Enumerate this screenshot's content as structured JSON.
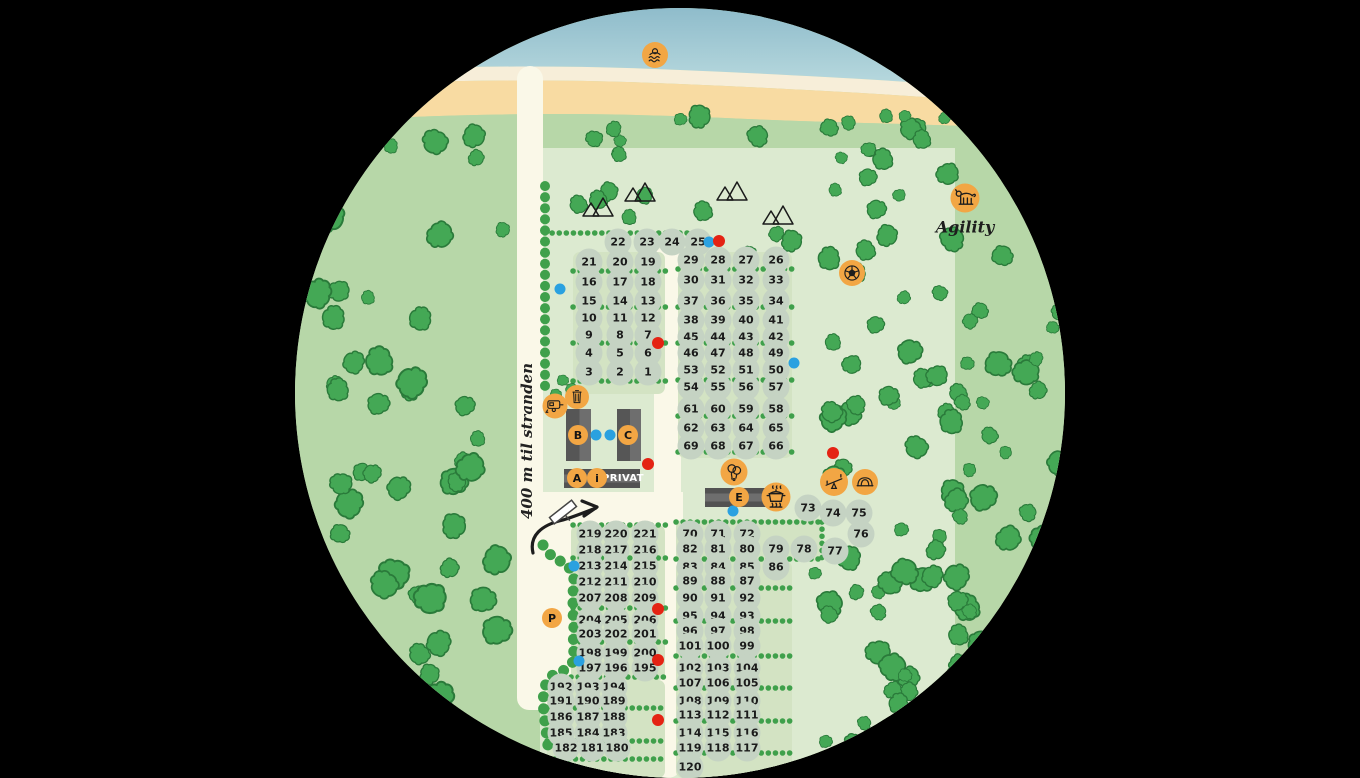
{
  "map": {
    "labels": {
      "road": "400 m til stranden",
      "agility": "Agility",
      "privat": "PRIVAT"
    },
    "colors": {
      "orange": "#f2a644",
      "blue_dot": "#2aa1e0",
      "red_dot": "#e42313",
      "tree": "#44a855",
      "hedge": "#3fa04b",
      "sea_top": "#8fbccb",
      "sea_bottom": "#bcdce0",
      "sand": "#f8dba2",
      "sand_stripe": "#f7eed9",
      "grass_outer": "#b7d7a8",
      "grass_camp": "#dcead0",
      "panel": "#d3e3c3",
      "road": "#faf8e8",
      "pitch": "#c5d3c3",
      "building": "#565656"
    },
    "letter_markers": [
      {
        "label": "B",
        "x": 283,
        "y": 427,
        "name": "building-b-marker"
      },
      {
        "label": "C",
        "x": 333,
        "y": 427,
        "name": "building-c-marker"
      },
      {
        "label": "A",
        "x": 282,
        "y": 470,
        "name": "building-a-marker"
      },
      {
        "label": "i",
        "x": 302,
        "y": 470,
        "name": "info-marker"
      },
      {
        "label": "E",
        "x": 444,
        "y": 489,
        "name": "building-e-marker"
      },
      {
        "label": "P",
        "x": 257,
        "y": 610,
        "name": "parking-marker"
      }
    ],
    "icon_markers": [
      {
        "name": "swimming-icon",
        "icon": "swim",
        "x": 360,
        "y": 47,
        "size": 26
      },
      {
        "name": "dog-agility-icon",
        "icon": "dog",
        "x": 670,
        "y": 190,
        "size": 29
      },
      {
        "name": "caravan-service-icon",
        "icon": "caravan",
        "x": 260,
        "y": 398,
        "size": 25
      },
      {
        "name": "trash-icon",
        "icon": "trash",
        "x": 282,
        "y": 389,
        "size": 24
      },
      {
        "name": "football-icon",
        "icon": "ball",
        "x": 557,
        "y": 265,
        "size": 26
      },
      {
        "name": "balloons-icon",
        "icon": "balloons",
        "x": 439,
        "y": 464,
        "size": 27
      },
      {
        "name": "cooking-pot-icon",
        "icon": "pot",
        "x": 481,
        "y": 489,
        "size": 29
      },
      {
        "name": "seesaw-icon",
        "icon": "seesaw",
        "x": 539,
        "y": 474,
        "size": 28
      },
      {
        "name": "climbing-dome-icon",
        "icon": "dome",
        "x": 570,
        "y": 474,
        "size": 26
      }
    ],
    "blocks": [
      {
        "id": "north-left",
        "rows": [
          {
            "y": 234,
            "xs": [
              323,
              352,
              377,
              403
            ],
            "nums": [
              "22",
              "23",
              "24",
              "25"
            ]
          },
          {
            "y": 254,
            "xs": [
              294,
              325,
              353
            ],
            "nums": [
              "21",
              "20",
              "19"
            ]
          },
          {
            "y": 274,
            "xs": [
              294,
              325,
              353
            ],
            "nums": [
              "16",
              "17",
              "18"
            ]
          },
          {
            "y": 293,
            "xs": [
              294,
              325,
              353
            ],
            "nums": [
              "15",
              "14",
              "13"
            ]
          },
          {
            "y": 310,
            "xs": [
              294,
              325,
              353
            ],
            "nums": [
              "10",
              "11",
              "12"
            ]
          },
          {
            "y": 327,
            "xs": [
              294,
              325,
              353
            ],
            "nums": [
              "9",
              "8",
              "7"
            ]
          },
          {
            "y": 345,
            "xs": [
              294,
              325,
              353
            ],
            "nums": [
              "4",
              "5",
              "6"
            ]
          },
          {
            "y": 364,
            "xs": [
              294,
              325,
              353
            ],
            "nums": [
              "3",
              "2",
              "1"
            ]
          }
        ]
      },
      {
        "id": "north-right",
        "rows": [
          {
            "y": 252,
            "xs": [
              396,
              423,
              451,
              481
            ],
            "nums": [
              "29",
              "28",
              "27",
              "26"
            ]
          },
          {
            "y": 272,
            "xs": [
              396,
              423,
              451,
              481
            ],
            "nums": [
              "30",
              "31",
              "32",
              "33"
            ]
          },
          {
            "y": 293,
            "xs": [
              396,
              423,
              451,
              481
            ],
            "nums": [
              "37",
              "36",
              "35",
              "34"
            ]
          },
          {
            "y": 312,
            "xs": [
              396,
              423,
              451,
              481
            ],
            "nums": [
              "38",
              "39",
              "40",
              "41"
            ]
          },
          {
            "y": 329,
            "xs": [
              396,
              423,
              451,
              481
            ],
            "nums": [
              "45",
              "44",
              "43",
              "42"
            ]
          },
          {
            "y": 345,
            "xs": [
              396,
              423,
              451,
              481
            ],
            "nums": [
              "46",
              "47",
              "48",
              "49"
            ]
          },
          {
            "y": 362,
            "xs": [
              396,
              423,
              451,
              481
            ],
            "nums": [
              "53",
              "52",
              "51",
              "50"
            ]
          },
          {
            "y": 379,
            "xs": [
              396,
              423,
              451,
              481
            ],
            "nums": [
              "54",
              "55",
              "56",
              "57"
            ]
          },
          {
            "y": 401,
            "xs": [
              396,
              423,
              451,
              481
            ],
            "nums": [
              "61",
              "60",
              "59",
              "58"
            ]
          },
          {
            "y": 420,
            "xs": [
              396,
              423,
              451,
              481
            ],
            "nums": [
              "62",
              "63",
              "64",
              "65"
            ]
          },
          {
            "y": 438,
            "xs": [
              396,
              423,
              451,
              481
            ],
            "nums": [
              "69",
              "68",
              "67",
              "66"
            ]
          }
        ]
      },
      {
        "id": "mid-right-70s",
        "rows": [
          {
            "y": 526,
            "xs": [
              395,
              423,
              452
            ],
            "nums": [
              "70",
              "71",
              "72"
            ]
          },
          {
            "y": 541,
            "xs": [
              395,
              423,
              452,
              481,
              509
            ],
            "nums": [
              "82",
              "81",
              "80",
              "79",
              "78"
            ]
          }
        ]
      },
      {
        "id": "south-right",
        "rows": [
          {
            "y": 559,
            "xs": [
              395,
              423,
              452,
              481
            ],
            "nums": [
              "83",
              "84",
              "85",
              "86"
            ]
          },
          {
            "y": 573,
            "xs": [
              395,
              423,
              452
            ],
            "nums": [
              "89",
              "88",
              "87"
            ]
          },
          {
            "y": 590,
            "xs": [
              395,
              423,
              452
            ],
            "nums": [
              "90",
              "91",
              "92"
            ]
          },
          {
            "y": 608,
            "xs": [
              395,
              423,
              452
            ],
            "nums": [
              "95",
              "94",
              "93"
            ]
          },
          {
            "y": 623,
            "xs": [
              395,
              423,
              452
            ],
            "nums": [
              "96",
              "97",
              "98"
            ]
          },
          {
            "y": 638,
            "xs": [
              395,
              423,
              452
            ],
            "nums": [
              "101",
              "100",
              "99"
            ]
          },
          {
            "y": 660,
            "xs": [
              395,
              423,
              452
            ],
            "nums": [
              "102",
              "103",
              "104"
            ]
          },
          {
            "y": 675,
            "xs": [
              395,
              423,
              452
            ],
            "nums": [
              "107",
              "106",
              "105"
            ]
          },
          {
            "y": 693,
            "xs": [
              395,
              423,
              452
            ],
            "nums": [
              "108",
              "109",
              "110"
            ]
          },
          {
            "y": 707,
            "xs": [
              395,
              423,
              452
            ],
            "nums": [
              "113",
              "112",
              "111"
            ]
          },
          {
            "y": 725,
            "xs": [
              395,
              423,
              452
            ],
            "nums": [
              "114",
              "115",
              "116"
            ]
          },
          {
            "y": 740,
            "xs": [
              395,
              423,
              452
            ],
            "nums": [
              "119",
              "118",
              "117"
            ]
          },
          {
            "y": 759,
            "xs": [
              395
            ],
            "nums": [
              "120"
            ]
          }
        ]
      },
      {
        "id": "south-left-200s",
        "rows": [
          {
            "y": 526,
            "xs": [
              295,
              321,
              350
            ],
            "nums": [
              "219",
              "220",
              "221"
            ]
          },
          {
            "y": 542,
            "xs": [
              295,
              321,
              350
            ],
            "nums": [
              "218",
              "217",
              "216"
            ]
          },
          {
            "y": 558,
            "xs": [
              295,
              321,
              350
            ],
            "nums": [
              "213",
              "214",
              "215"
            ]
          },
          {
            "y": 574,
            "xs": [
              295,
              321,
              350
            ],
            "nums": [
              "212",
              "211",
              "210"
            ]
          },
          {
            "y": 590,
            "xs": [
              295,
              321,
              350
            ],
            "nums": [
              "207",
              "208",
              "209"
            ]
          },
          {
            "y": 612,
            "xs": [
              295,
              321,
              350
            ],
            "nums": [
              "204",
              "205",
              "206"
            ]
          },
          {
            "y": 626,
            "xs": [
              295,
              321,
              350
            ],
            "nums": [
              "203",
              "202",
              "201"
            ]
          },
          {
            "y": 645,
            "xs": [
              295,
              321,
              350
            ],
            "nums": [
              "198",
              "199",
              "200"
            ]
          },
          {
            "y": 660,
            "xs": [
              295,
              321,
              350
            ],
            "nums": [
              "197",
              "196",
              "195"
            ]
          }
        ]
      },
      {
        "id": "south-left-180s",
        "rows": [
          {
            "y": 679,
            "xs": [
              266,
              293,
              319
            ],
            "nums": [
              "192",
              "193",
              "194"
            ]
          },
          {
            "y": 693,
            "xs": [
              266,
              293,
              319
            ],
            "nums": [
              "191",
              "190",
              "189"
            ]
          },
          {
            "y": 709,
            "xs": [
              266,
              293,
              319
            ],
            "nums": [
              "186",
              "187",
              "188"
            ]
          },
          {
            "y": 725,
            "xs": [
              266,
              293,
              319
            ],
            "nums": [
              "185",
              "184",
              "183"
            ]
          },
          {
            "y": 740,
            "xs": [
              271,
              297,
              322
            ],
            "nums": [
              "182",
              "181",
              "180"
            ]
          }
        ]
      }
    ],
    "free_pitches": [
      {
        "x": 513,
        "y": 500,
        "num": "73"
      },
      {
        "x": 538,
        "y": 505,
        "num": "74"
      },
      {
        "x": 564,
        "y": 505,
        "num": "75"
      },
      {
        "x": 566,
        "y": 526,
        "num": "76"
      },
      {
        "x": 540,
        "y": 543,
        "num": "77"
      }
    ],
    "dots": [
      {
        "x": 414,
        "y": 234,
        "color": "blue"
      },
      {
        "x": 424,
        "y": 233,
        "color": "red"
      },
      {
        "x": 265,
        "y": 281,
        "color": "blue"
      },
      {
        "x": 363,
        "y": 335,
        "color": "red"
      },
      {
        "x": 499,
        "y": 355,
        "color": "blue"
      },
      {
        "x": 301,
        "y": 427,
        "color": "blue"
      },
      {
        "x": 315,
        "y": 427,
        "color": "blue"
      },
      {
        "x": 353,
        "y": 456,
        "color": "red"
      },
      {
        "x": 538,
        "y": 445,
        "color": "red"
      },
      {
        "x": 438,
        "y": 503,
        "color": "blue"
      },
      {
        "x": 279,
        "y": 558,
        "color": "blue"
      },
      {
        "x": 363,
        "y": 601,
        "color": "red"
      },
      {
        "x": 284,
        "y": 653,
        "color": "blue"
      },
      {
        "x": 363,
        "y": 652,
        "color": "red"
      },
      {
        "x": 363,
        "y": 712,
        "color": "red"
      }
    ]
  }
}
